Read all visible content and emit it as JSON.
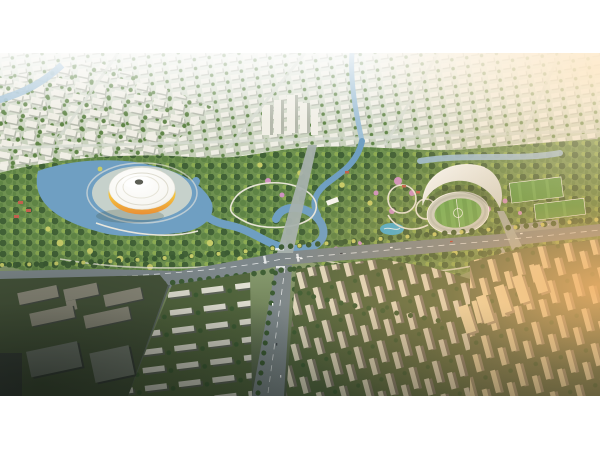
{
  "frame": {
    "canvas_width": 600,
    "canvas_height": 450,
    "photo_top": 53,
    "photo_height": 343,
    "letterbox_color": "#ffffff"
  },
  "scene": {
    "name": "city-sports-park-aerial-rendering",
    "landmarks": [
      "saucer-arena-with-yellow-ring",
      "crescent-roof-stadium",
      "running-track-and-pitch",
      "training-fields",
      "parking-lot",
      "central-park-lake",
      "meandering-river",
      "main-boulevard",
      "north-south-avenue",
      "row-house-district",
      "residential-slab-district",
      "sunlit-tower-district",
      "office-blocks-in-shadow",
      "background-cityscape",
      "sunset-glow"
    ]
  },
  "colors": {
    "haze": "#e7ece3",
    "buildingLight": "#f1efe6",
    "buildingShade": "#b5b9ac",
    "treeDark": "#3c5c33",
    "treeMid": "#5d8344",
    "treeLight": "#8fae52",
    "treeAccent": "#c6cb68",
    "treePink": "#cf93c1",
    "parkBase": "#6e9150",
    "water": "#6f9fc2",
    "waterLight": "#9dbfd6",
    "cyanPool": "#49b0d8",
    "road": "#7e888b",
    "roadLight": "#a7b1ad",
    "roadDark": "#5a6462",
    "path": "#efeade",
    "plaza": "#d6d9cd",
    "domeWhite": "#f7f6f1",
    "arenaYellow": "#f5c33e",
    "arenaOrange": "#ea8f35",
    "roofWhite": "#f2f3f0",
    "track": "#ccd2c8",
    "pitch": "#63a24e",
    "pitchStripe": "#74b45b",
    "fieldGreen": "#5c9c49",
    "parking": "#98a19a",
    "lawn": "#53663e",
    "lawnDark": "#46543a",
    "rowWhite": "#e9e6da",
    "rowShade": "#60655a",
    "slabLit": "#e3dcc3",
    "slabShade": "#7e786b",
    "sunTower": "#eeddb0",
    "sunTowerShade": "#9d9179",
    "darkBlock": "#474d45",
    "darkBlockTop": "#8d8b7c",
    "darkDeep": "#3a403a",
    "glowWarm": "#f5b46a",
    "glowPale": "#ffe6c0",
    "redRoof": "#c2604e",
    "carWhite": "#f5f5f5",
    "carDark": "#44494f",
    "carRed": "#c23b30",
    "white": "#ffffff"
  }
}
